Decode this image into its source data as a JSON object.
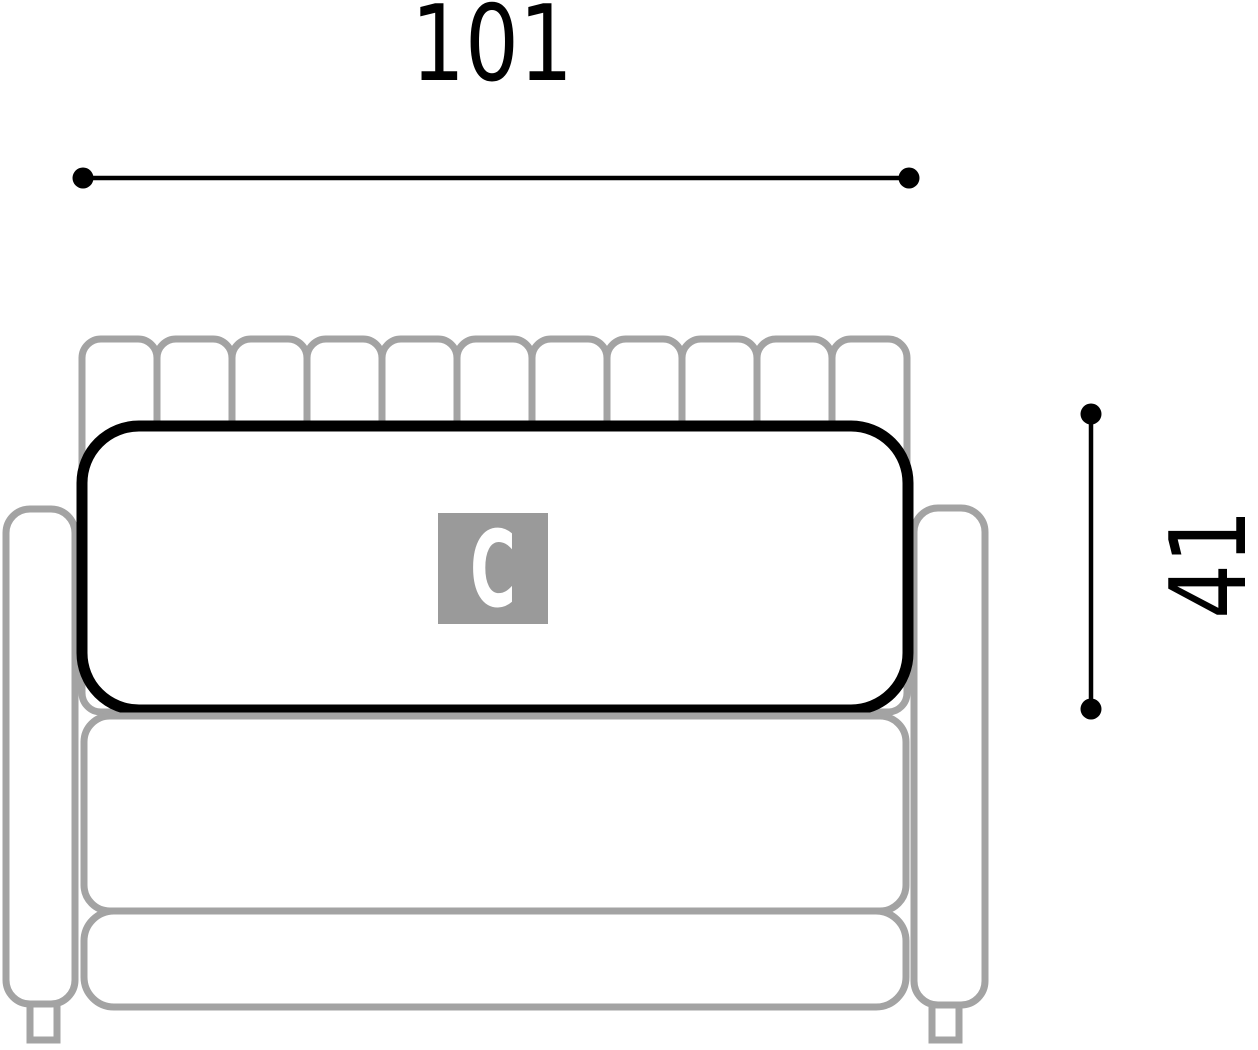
{
  "diagram": {
    "width_dimension": "101",
    "height_dimension": "41",
    "module_label": "C",
    "back_channel_count": 11,
    "colors": {
      "outline_gray": "#a3a3a3",
      "outline_black": "#000000",
      "dimension_black": "#000000",
      "label_box_gray": "#9a9a9a",
      "label_text_white": "#ffffff",
      "background": "#ffffff"
    }
  }
}
